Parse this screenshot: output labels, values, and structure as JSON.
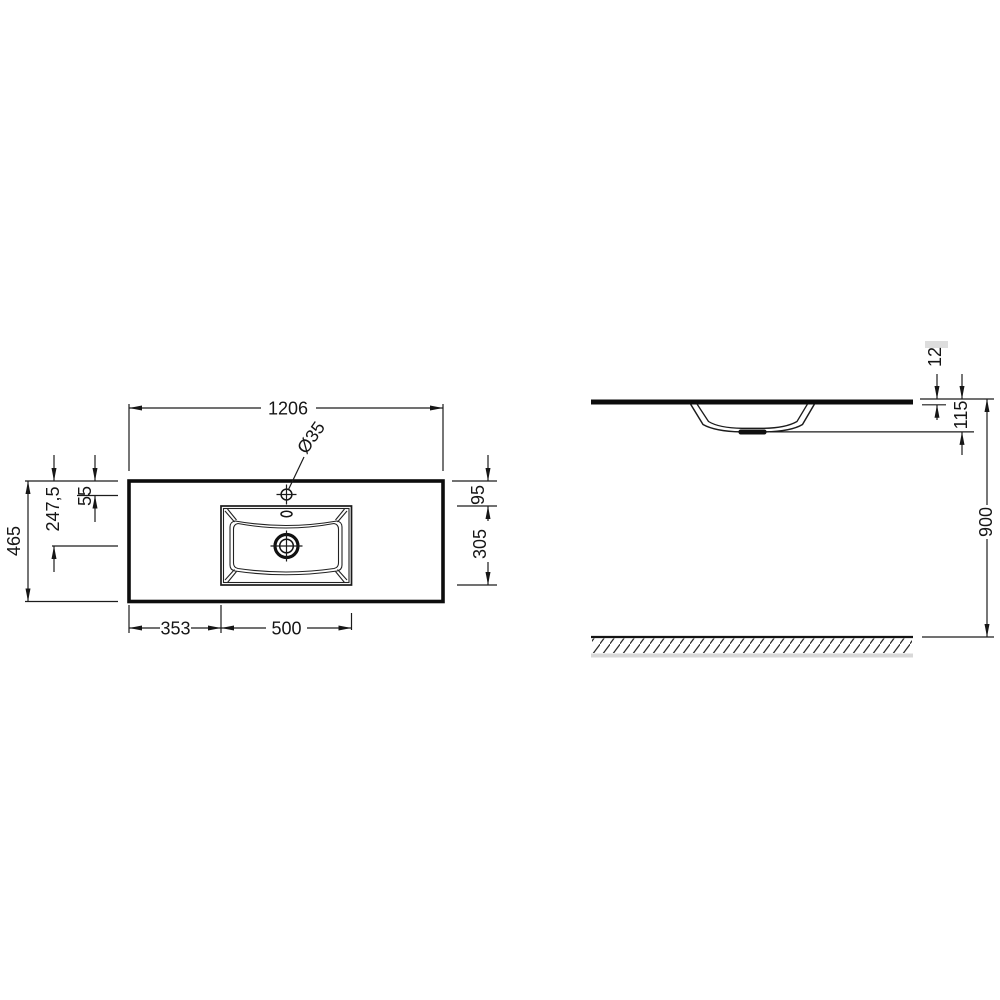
{
  "drawing": {
    "kind": "washbasin-countertop-technical-drawing",
    "background_color": "#ffffff",
    "line_color": "#161616",
    "hatch_shadow_color": "#d8d8d8",
    "views": {
      "plan": {
        "labels": {
          "overall_width": "1206",
          "faucet_hole": "Ø35",
          "overall_depth": "465",
          "drain_axis_depth": "247,5",
          "faucet_axis_depth": "55",
          "basin_front_offset": "95",
          "basin_depth": "305",
          "basin_left_offset": "353",
          "basin_width": "500"
        }
      },
      "side": {
        "labels": {
          "countertop_thickness": "12",
          "bowl_height": "115",
          "installation_height": "900"
        }
      }
    }
  }
}
